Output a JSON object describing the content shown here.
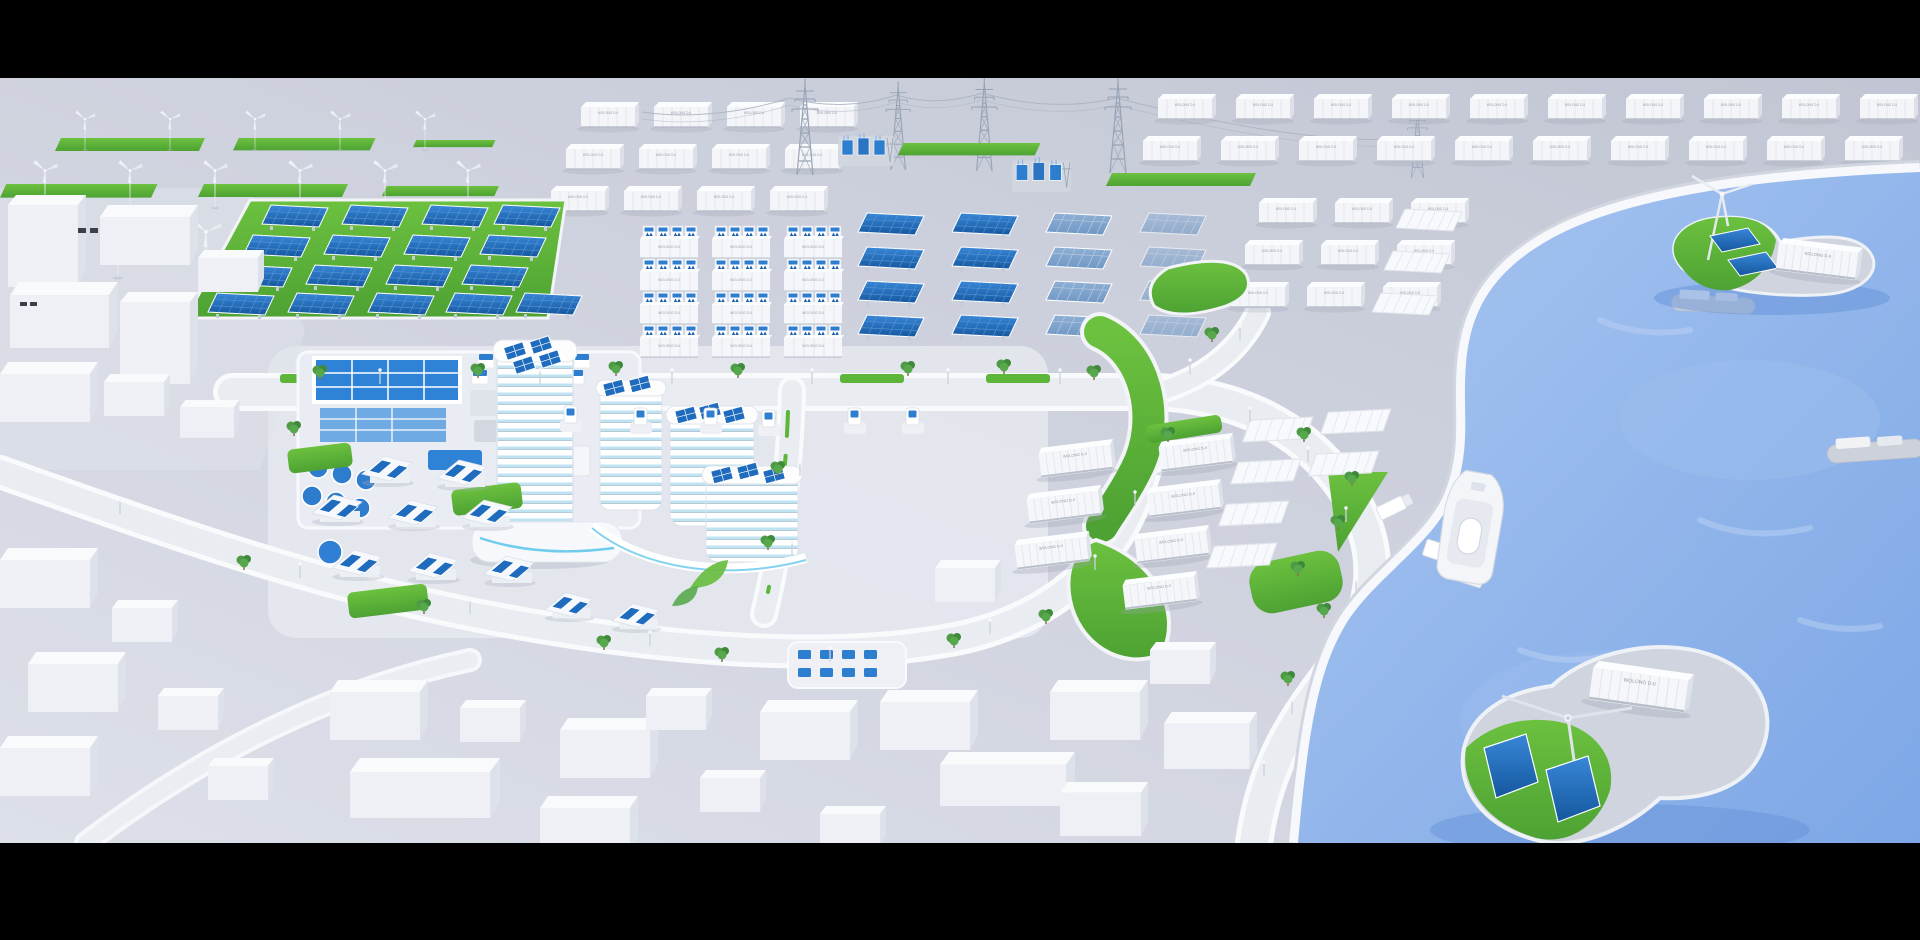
{
  "scene": {
    "type": "3d-isometric-render",
    "subject": "smart green-energy city: wind farm, solar farms, battery storage containers, substation pylons, eco campus, harbor with energy islands",
    "letterbox": {
      "top_bar": true,
      "bottom_bar": true
    }
  },
  "labels": {
    "container_label": "WOLONG D-II"
  },
  "colors": {
    "black_bar": "#000000",
    "ground": "#c6cad7",
    "ground_light": "#dcdfe8",
    "road": "#e9ecf1",
    "road_edge": "#f8fafc",
    "building_white": "#f2f4f8",
    "accent": "#2e7ecf",
    "panel": "#1f6cbe",
    "cyan": "#4fc0e8",
    "grass": "#5db53a",
    "grass_dark": "#479f33",
    "water": "#84abe8",
    "water_light": "#b3cdf4",
    "tree": "#4e9a45",
    "steel": "#98a4b6"
  },
  "objects": {
    "wind_turbines_onshore": 17,
    "wind_turbines_islands": 2,
    "storage_container_rows": "white battery storage containers in grids",
    "battery_inverter_stacks": 3,
    "solar_field_panels": 17,
    "ground_solar_arrays": 16,
    "transmission_pylons": 5,
    "substations": 2,
    "ev_chargers": 6,
    "ships": 3,
    "energy_islands": 2,
    "solar_houses": 10
  }
}
